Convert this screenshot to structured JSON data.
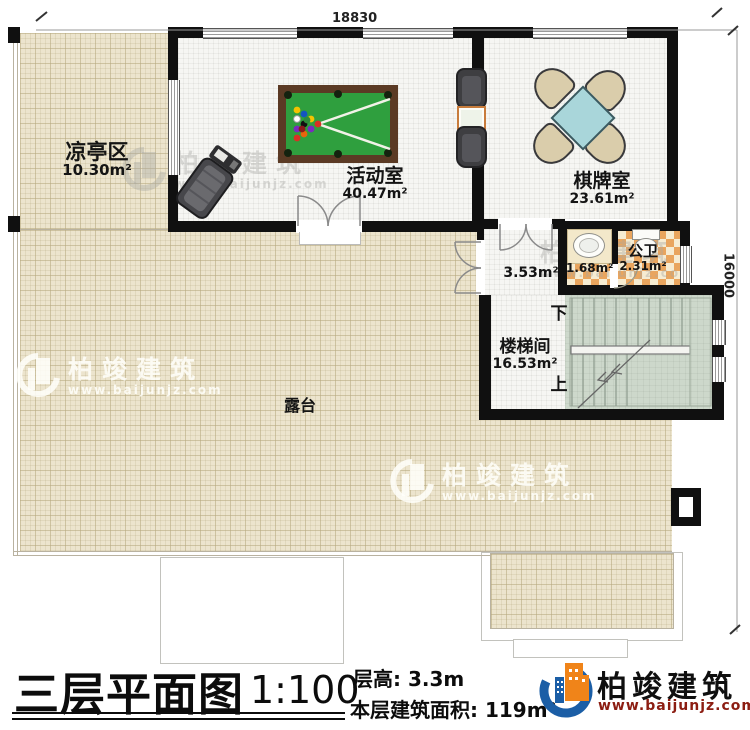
{
  "title_block": {
    "title": "三层平面图",
    "scale": "1:100",
    "floor_height": "层高: 3.3m",
    "floor_area": "本层建筑面积: 119m²"
  },
  "dimensions": {
    "top": "18830",
    "right": "16000"
  },
  "rooms": {
    "pavilion": {
      "name": "凉亭区",
      "area": "10.30m²"
    },
    "activity": {
      "name": "活动室",
      "area": "40.47m²"
    },
    "chess": {
      "name": "棋牌室",
      "area": "23.61m²"
    },
    "hallway": {
      "area": "3.53m²"
    },
    "washroom": {
      "area": "1.68m²"
    },
    "toilet": {
      "name": "公卫",
      "area": "2.31m²"
    },
    "stairwell": {
      "name": "楼梯间",
      "area": "16.53m²",
      "down_label": "下",
      "up_label": "上"
    },
    "terrace": {
      "name": "露台"
    }
  },
  "brand": {
    "name": "柏竣建筑",
    "website": "www.baijunjz.com"
  },
  "watermark": {
    "name": "柏竣建筑",
    "website": "www.baijunjz.com"
  },
  "colors": {
    "wall": "#101010",
    "terrace_floor": "#ece4cd",
    "room_floor": "#f6f6f3",
    "stair_floor": "#cdd8cb",
    "tile_orange": "#e9a55e",
    "tile_cream": "#f6ecd2",
    "pool_felt": "#2f9f3e",
    "pool_rim": "#5b3a24",
    "chess_table_blue": "#a9d6da",
    "chair_tan": "#dacdab",
    "logo_blue": "#1b5ea6",
    "logo_orange": "#f08419",
    "logo_url_red": "#8c1d12"
  }
}
